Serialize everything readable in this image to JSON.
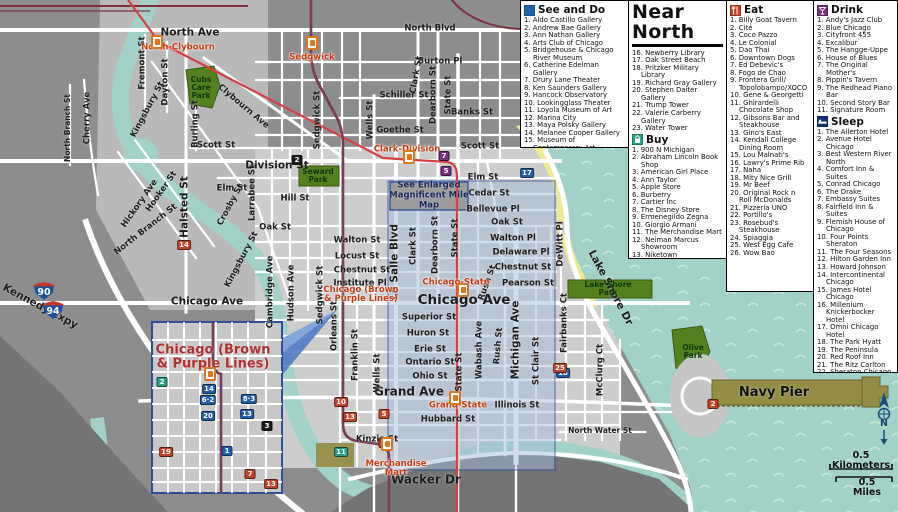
{
  "title": "Near North",
  "legend": {
    "see_and_do": {
      "label": "See and Do",
      "items": [
        "Aldo Castillo Gallery",
        "Andrew Bae Gallery",
        "Ann Nathan Gallery",
        "Arts Club of Chicago",
        "Bridgehouse & Chicago River Museum",
        "Catherine Edelman Gallery",
        "Drury Lane Theater",
        "Ken Saunders Gallery",
        "Hancock Observatory",
        "Lookingglass Theater",
        "Loyola Museum of Art",
        "Marina City",
        "Maya Polsky Gallery",
        "Melanee Cooper Gallery",
        "Museum of Contemporary Art",
        "Newberry Library",
        "Oak Street Beach",
        "Pritzker Military Library",
        "Richard Gray Gallery",
        "Stephen Daiter Gallery",
        "Trump Tower",
        "Valerie Carberry Gallery",
        "Water Tower"
      ]
    },
    "buy": {
      "label": "Buy",
      "items": [
        "900 N Michigan",
        "Abraham Lincoln Book Shop",
        "American Girl Place",
        "Ann Taylor",
        "Apple Store",
        "Burberry",
        "Cartier Inc",
        "The Disney Store",
        "Ermenegildo Zegna",
        "Giorgio Armani",
        "The Merchandise Mart",
        "Neiman Marcus Showroom",
        "Niketown",
        "Nordstrom's",
        "Westfield North Bridge",
        "Old Plank Antiques",
        "Salvatore Ferragamo",
        "Tails in the City",
        "Tiffany & Co",
        "Water Tower Place"
      ]
    },
    "eat": {
      "label": "Eat",
      "items": [
        "Billy Goat Tavern",
        "Cité",
        "Coco Pazzo",
        "Le Colonial",
        "Dao Thai",
        "Downtown Dogs",
        "Ed Debevic's",
        "Fogo de Chao",
        "Frontera Grill/ Topolobampo/XOCO",
        "Gene & Georgetti",
        "Ghirardelli Chocolate Shop",
        "Gibsons Bar and Steakhouse",
        "Gino's East",
        "Kendall College Dining Room",
        "Lou Malnati's",
        "Lawry's Prime Rib",
        "Naha",
        "Mity Nice Grill",
        "Mr Beef",
        "Original Rock n Roll McDonalds",
        "Pizzeria UNO",
        "Portillo's",
        "Rosebud's Steakhouse",
        "Spiaggia",
        "West Egg Cafe",
        "Wow Bao"
      ]
    },
    "drink": {
      "label": "Drink",
      "items": [
        "Andy's Jazz Club",
        "Blue Chicago",
        "Cityfront 455",
        "Excalibur",
        "The Hangge-Uppe",
        "House of Blues",
        "The Original Mother's",
        "Pippin's Tavern",
        "The Redhead Piano Bar",
        "Second Story Bar",
        "Signature Room"
      ]
    },
    "sleep": {
      "label": "Sleep",
      "items": [
        "The Allerton Hotel",
        "Avenue Hotel Chicago",
        "Best Western River North",
        "Comfort Inn & Suites",
        "Conrad Chicago",
        "The Drake",
        "Embassy Suites",
        "Fairfield Inn & Suites",
        "Flemish House of Chicago",
        "Four Points Sheraton",
        "The Four Seasons",
        "Hilton Garden Inn",
        "Howard Johnson",
        "Intercontinental Chicago",
        "James Hotel Chicago",
        "Millenium Knickerbocker Hotel",
        "Omni Chicago Hotel",
        "The Park Hyatt",
        "The Peninsula",
        "Red Roof Inn",
        "The Ritz Carlton",
        "Sheraton Chicago",
        "The Talbott Hotel",
        "Tokyo Hotel",
        "The Whitehall Hotel",
        "Wyndham Chicago Hotel"
      ]
    },
    "contact": {
      "label": "Contact",
      "items": [
        "Biznet Internet Cafe",
        "Cyber Cafe",
        "Near North Library"
      ]
    }
  },
  "map": {
    "labels": [
      {
        "t": "North Ave",
        "x": 190,
        "y": 33,
        "c": "stmd"
      },
      {
        "t": "North Blvd",
        "x": 430,
        "y": 29,
        "c": "st"
      },
      {
        "t": "Burton Pl",
        "x": 440,
        "y": 62,
        "c": "st"
      },
      {
        "t": "Schiller St",
        "x": 404,
        "y": 96,
        "c": "st"
      },
      {
        "t": "Banks St",
        "x": 472,
        "y": 113,
        "c": "st"
      },
      {
        "t": "Goethe St",
        "x": 400,
        "y": 131,
        "c": "st"
      },
      {
        "t": "Scott St",
        "x": 216,
        "y": 146,
        "c": "st"
      },
      {
        "t": "Scott St",
        "x": 480,
        "y": 147,
        "c": "st"
      },
      {
        "t": "Division St",
        "x": 277,
        "y": 166,
        "c": "stmd"
      },
      {
        "t": "Elm St",
        "x": 232,
        "y": 189,
        "c": "st"
      },
      {
        "t": "Elm St",
        "x": 483,
        "y": 178,
        "c": "st"
      },
      {
        "t": "Cedar St",
        "x": 489,
        "y": 194,
        "c": "st"
      },
      {
        "t": "Bellevue Pl",
        "x": 493,
        "y": 210,
        "c": "st"
      },
      {
        "t": "Hill St",
        "x": 295,
        "y": 199,
        "c": "st"
      },
      {
        "t": "Oak St",
        "x": 275,
        "y": 228,
        "c": "st"
      },
      {
        "t": "Oak St",
        "x": 507,
        "y": 223,
        "c": "st"
      },
      {
        "t": "Walton St",
        "x": 357,
        "y": 241,
        "c": "st"
      },
      {
        "t": "Walton Pl",
        "x": 513,
        "y": 239,
        "c": "st"
      },
      {
        "t": "Locust St",
        "x": 357,
        "y": 257,
        "c": "st"
      },
      {
        "t": "Chestnut St",
        "x": 362,
        "y": 271,
        "c": "st"
      },
      {
        "t": "Chestnut St",
        "x": 523,
        "y": 268,
        "c": "st"
      },
      {
        "t": "Delaware Pl",
        "x": 521,
        "y": 253,
        "c": "st"
      },
      {
        "t": "Pearson St",
        "x": 528,
        "y": 284,
        "c": "st"
      },
      {
        "t": "Institute Pl",
        "x": 360,
        "y": 284,
        "c": "st"
      },
      {
        "t": "Chicago Ave",
        "x": 207,
        "y": 302,
        "c": "stmd"
      },
      {
        "t": "Chicago Ave",
        "x": 464,
        "y": 300,
        "c": "stxl"
      },
      {
        "t": "Superior St",
        "x": 429,
        "y": 318,
        "c": "st"
      },
      {
        "t": "Huron St",
        "x": 428,
        "y": 334,
        "c": "st"
      },
      {
        "t": "Erie St",
        "x": 430,
        "y": 350,
        "c": "st"
      },
      {
        "t": "Ontario St",
        "x": 430,
        "y": 363,
        "c": "st"
      },
      {
        "t": "Ohio St",
        "x": 430,
        "y": 377,
        "c": "st"
      },
      {
        "t": "Grand Ave",
        "x": 409,
        "y": 392,
        "c": "stlg"
      },
      {
        "t": "Illinois St",
        "x": 517,
        "y": 406,
        "c": "st"
      },
      {
        "t": "Hubbard St",
        "x": 448,
        "y": 420,
        "c": "st"
      },
      {
        "t": "Kinzie St",
        "x": 377,
        "y": 440,
        "c": "st"
      },
      {
        "t": "Wacker Dr",
        "x": 426,
        "y": 480,
        "c": "stlg"
      },
      {
        "t": "North Water St",
        "x": 600,
        "y": 431,
        "c": "stsm"
      },
      {
        "t": "Fremont St",
        "x": 143,
        "y": 63,
        "r": -90,
        "c": "st"
      },
      {
        "t": "Dayton St",
        "x": 166,
        "y": 82,
        "r": -90,
        "c": "st"
      },
      {
        "t": "Burling St",
        "x": 196,
        "y": 124,
        "r": -90,
        "c": "st"
      },
      {
        "t": "North Branch St",
        "x": 68,
        "y": 128,
        "r": -90,
        "c": "stsm"
      },
      {
        "t": "Cherry Ave",
        "x": 88,
        "y": 118,
        "r": -90,
        "c": "st"
      },
      {
        "t": "Halsted St",
        "x": 185,
        "y": 207,
        "r": -90,
        "c": "stmd"
      },
      {
        "t": "Larrabee St",
        "x": 253,
        "y": 193,
        "r": -90,
        "c": "st"
      },
      {
        "t": "Clark St",
        "x": 417,
        "y": 75,
        "r": -80,
        "c": "st"
      },
      {
        "t": "Dearborn St",
        "x": 434,
        "y": 95,
        "r": -90,
        "c": "st"
      },
      {
        "t": "State St",
        "x": 449,
        "y": 95,
        "r": -90,
        "c": "st"
      },
      {
        "t": "Wells St",
        "x": 371,
        "y": 120,
        "r": -90,
        "c": "st"
      },
      {
        "t": "Sedgwick St",
        "x": 318,
        "y": 120,
        "r": -90,
        "c": "st"
      },
      {
        "t": "Cambridge Ave",
        "x": 271,
        "y": 292,
        "r": -90,
        "c": "st"
      },
      {
        "t": "Hudson Ave",
        "x": 292,
        "y": 293,
        "r": -90,
        "c": "st"
      },
      {
        "t": "Sedgwick St",
        "x": 321,
        "y": 295,
        "r": -90,
        "c": "st"
      },
      {
        "t": "Orleans St",
        "x": 335,
        "y": 326,
        "r": -90,
        "c": "st"
      },
      {
        "t": "Franklin St",
        "x": 356,
        "y": 355,
        "r": -90,
        "c": "st"
      },
      {
        "t": "Wells St",
        "x": 378,
        "y": 373,
        "r": -90,
        "c": "st"
      },
      {
        "t": "La Salle Blvd",
        "x": 395,
        "y": 262,
        "r": -90,
        "c": "stmd"
      },
      {
        "t": "Clark St",
        "x": 414,
        "y": 246,
        "r": -90,
        "c": "st"
      },
      {
        "t": "Dearborn St",
        "x": 436,
        "y": 245,
        "r": -90,
        "c": "st"
      },
      {
        "t": "State St",
        "x": 456,
        "y": 238,
        "r": -90,
        "c": "st"
      },
      {
        "t": "State St",
        "x": 460,
        "y": 372,
        "r": -90,
        "c": "st"
      },
      {
        "t": "Wabash Ave",
        "x": 480,
        "y": 350,
        "r": -90,
        "c": "st"
      },
      {
        "t": "Michigan Ave",
        "x": 516,
        "y": 340,
        "r": -90,
        "c": "stmd"
      },
      {
        "t": "St Clair St",
        "x": 537,
        "y": 361,
        "r": -90,
        "c": "st"
      },
      {
        "t": "DeWitt Pl",
        "x": 561,
        "y": 244,
        "r": -90,
        "c": "st"
      },
      {
        "t": "Fairbanks Ct",
        "x": 565,
        "y": 323,
        "r": -90,
        "c": "st"
      },
      {
        "t": "McClurg Ct",
        "x": 601,
        "y": 370,
        "r": -90,
        "c": "st"
      },
      {
        "t": "Rush St",
        "x": 488,
        "y": 283,
        "r": -70,
        "c": "st"
      },
      {
        "t": "Rush St",
        "x": 499,
        "y": 346,
        "r": -85,
        "c": "st"
      },
      {
        "t": "Clybourn Ave",
        "x": 243,
        "y": 107,
        "r": 40,
        "c": "st"
      },
      {
        "t": "Kingsbury St",
        "x": 148,
        "y": 110,
        "r": -62,
        "c": "st"
      },
      {
        "t": "Kingsbury St",
        "x": 242,
        "y": 260,
        "r": -62,
        "c": "st"
      },
      {
        "t": "Crosby St",
        "x": 231,
        "y": 205,
        "r": -62,
        "c": "st"
      },
      {
        "t": "Hooker St",
        "x": 162,
        "y": 192,
        "r": -55,
        "c": "st"
      },
      {
        "t": "Hickory Ave",
        "x": 140,
        "y": 204,
        "r": -55,
        "c": "st"
      },
      {
        "t": "North Branch St",
        "x": 146,
        "y": 230,
        "r": -38,
        "c": "st"
      },
      {
        "t": "Kennedy Expy",
        "x": 40,
        "y": 307,
        "r": 28,
        "c": "stmd"
      },
      {
        "t": "Lake Shore Dr",
        "x": 610,
        "y": 288,
        "r": 62,
        "c": "stmd"
      },
      {
        "t": "Cubs\nCare\nPark",
        "x": 201,
        "y": 88,
        "c": "park"
      },
      {
        "t": "Seward\nPark",
        "x": 318,
        "y": 176,
        "c": "park"
      },
      {
        "t": "Lake Shore\nPark",
        "x": 608,
        "y": 289,
        "c": "park"
      },
      {
        "t": "Olive\nPark",
        "x": 693,
        "y": 352,
        "c": "park"
      },
      {
        "t": "Navy Pier",
        "x": 774,
        "y": 393,
        "c": "navy"
      },
      {
        "t": "North-Clybourn",
        "x": 178,
        "y": 48,
        "c": "station"
      },
      {
        "t": "Sedgwick",
        "x": 312,
        "y": 58,
        "c": "station"
      },
      {
        "t": "Clark-Division",
        "x": 407,
        "y": 150,
        "c": "station"
      },
      {
        "t": "Chicago-State",
        "x": 456,
        "y": 283,
        "c": "station"
      },
      {
        "t": "Grand-State",
        "x": 458,
        "y": 406,
        "c": "station"
      },
      {
        "t": "Merchandise\nMart",
        "x": 396,
        "y": 469,
        "c": "station"
      },
      {
        "t": "Chicago (Brown\n& Purple Lines)",
        "x": 361,
        "y": 295,
        "c": "station"
      },
      {
        "t": "Chicago (Brown\n& Purple Lines)",
        "x": 213,
        "y": 357,
        "c": "insettitle"
      },
      {
        "t": "See Enlarged\nMagnificent Mile\nMap",
        "x": 429,
        "y": 196,
        "c": "note"
      },
      {
        "t": "0.5 Kilometers",
        "x": 861,
        "y": 461,
        "c": "scale"
      },
      {
        "t": "0.5 Miles",
        "x": 867,
        "y": 488,
        "c": "scale"
      },
      {
        "t": "N",
        "x": 884,
        "y": 424,
        "c": "compass"
      }
    ],
    "markers": [
      {
        "n": "17",
        "c": "see",
        "x": 527,
        "y": 173
      },
      {
        "n": "18",
        "c": "see",
        "x": 563,
        "y": 373
      },
      {
        "n": "7",
        "c": "drink",
        "x": 444,
        "y": 156
      },
      {
        "n": "5",
        "c": "drink",
        "x": 446,
        "y": 171
      },
      {
        "n": "2",
        "c": "contact",
        "x": 297,
        "y": 160
      },
      {
        "n": "14",
        "c": "eat",
        "x": 184,
        "y": 245
      },
      {
        "n": "10",
        "c": "eat",
        "x": 341,
        "y": 402
      },
      {
        "n": "13",
        "c": "eat",
        "x": 350,
        "y": 417
      },
      {
        "n": "5",
        "c": "eat",
        "x": 384,
        "y": 414
      },
      {
        "n": "9",
        "c": "eat",
        "x": 384,
        "y": 443
      },
      {
        "n": "25",
        "c": "eat",
        "x": 560,
        "y": 368
      },
      {
        "n": "2",
        "c": "eat",
        "x": 713,
        "y": 404
      },
      {
        "n": "11",
        "c": "buy",
        "x": 341,
        "y": 452
      },
      {
        "n": "2",
        "c": "buy",
        "x": 162,
        "y": 382
      },
      {
        "n": "14",
        "c": "see",
        "x": 209,
        "y": 389
      },
      {
        "n": "6·2",
        "c": "see",
        "x": 208,
        "y": 400
      },
      {
        "n": "8·3",
        "c": "see",
        "x": 249,
        "y": 399
      },
      {
        "n": "20",
        "c": "see",
        "x": 208,
        "y": 416
      },
      {
        "n": "13",
        "c": "see",
        "x": 247,
        "y": 414
      },
      {
        "n": "1",
        "c": "see",
        "x": 227,
        "y": 451
      },
      {
        "n": "19",
        "c": "eat",
        "x": 166,
        "y": 452
      },
      {
        "n": "7",
        "c": "eat",
        "x": 250,
        "y": 474
      },
      {
        "n": "13",
        "c": "eat",
        "x": 271,
        "y": 484
      },
      {
        "n": "3",
        "c": "contact",
        "x": 267,
        "y": 426
      }
    ],
    "stations": [
      {
        "x": 157,
        "y": 42
      },
      {
        "x": 312,
        "y": 43
      },
      {
        "x": 409,
        "y": 157
      },
      {
        "x": 463,
        "y": 290
      },
      {
        "x": 455,
        "y": 398
      },
      {
        "x": 387,
        "y": 444
      },
      {
        "x": 210,
        "y": 374
      }
    ],
    "shields": [
      {
        "n": "90",
        "x": 44,
        "y": 291
      },
      {
        "n": "94",
        "x": 53,
        "y": 310
      }
    ]
  }
}
